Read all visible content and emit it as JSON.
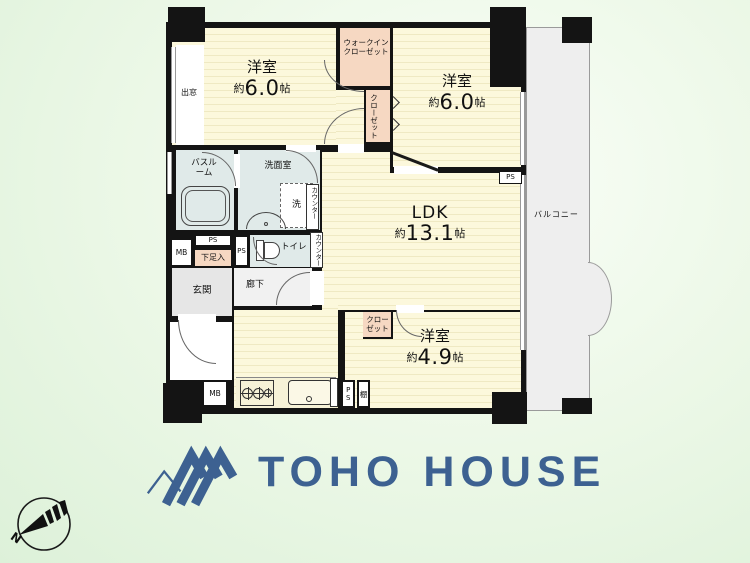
{
  "colors": {
    "background_green": "#e8f6e4",
    "room_yellow": "#fcf8dc",
    "room_stripe": "#efe9c3",
    "closet_salmon": "#f6d8c2",
    "wet_area_blue": "#e0eae9",
    "hall_gray": "#ededed",
    "balcony_gray": "#eeeeee",
    "wall_black": "#141414",
    "logo_blue": "#3d6191"
  },
  "plan": {
    "bedroom1": {
      "name": "洋室",
      "size_prefix": "約",
      "size_value": "6.0",
      "size_unit": "帖"
    },
    "bedroom2": {
      "name": "洋室",
      "size_prefix": "約",
      "size_value": "6.0",
      "size_unit": "帖"
    },
    "ldk": {
      "name": "LDK",
      "size_prefix": "約",
      "size_value": "13.1",
      "size_unit": "帖"
    },
    "bedroom3": {
      "name": "洋室",
      "size_prefix": "約",
      "size_value": "4.9",
      "size_unit": "帖"
    },
    "labels": {
      "walk_in_closet": "ウォークインクローゼット",
      "closet_mid": "クローゼット",
      "closet_bedroom3": "クローゼット",
      "bay_window": "出窓",
      "bathroom": "バスルーム",
      "washroom": "洗面室",
      "laundry": "洗",
      "counter_washroom": "カウンター",
      "counter_toilet": "カウンター",
      "toilet": "トイレ",
      "shoe_cabinet": "下足入",
      "entrance": "玄関",
      "hallway": "廊下",
      "balcony": "バルコニー",
      "shelf": "棚",
      "ps_entrance": "PS",
      "ps_hall": "PS",
      "ps_bedroom2": "PS",
      "ps_kitchen": "PS",
      "mb_entrance": "MB",
      "mb_kitchen": "MB"
    }
  },
  "icons": {
    "logo_mark": "roof-chevrons",
    "compass": "north-arrow",
    "bathtub": "bathtub-outline",
    "stove": "two-burner-stove",
    "kitchen_sink": "sink-basin",
    "washbasin": "half-oval-basin",
    "toilet_bowl": "toilet-side-view"
  },
  "branding": {
    "logo_text": "TOHO HOUSE"
  },
  "compass": {
    "label": "N"
  }
}
